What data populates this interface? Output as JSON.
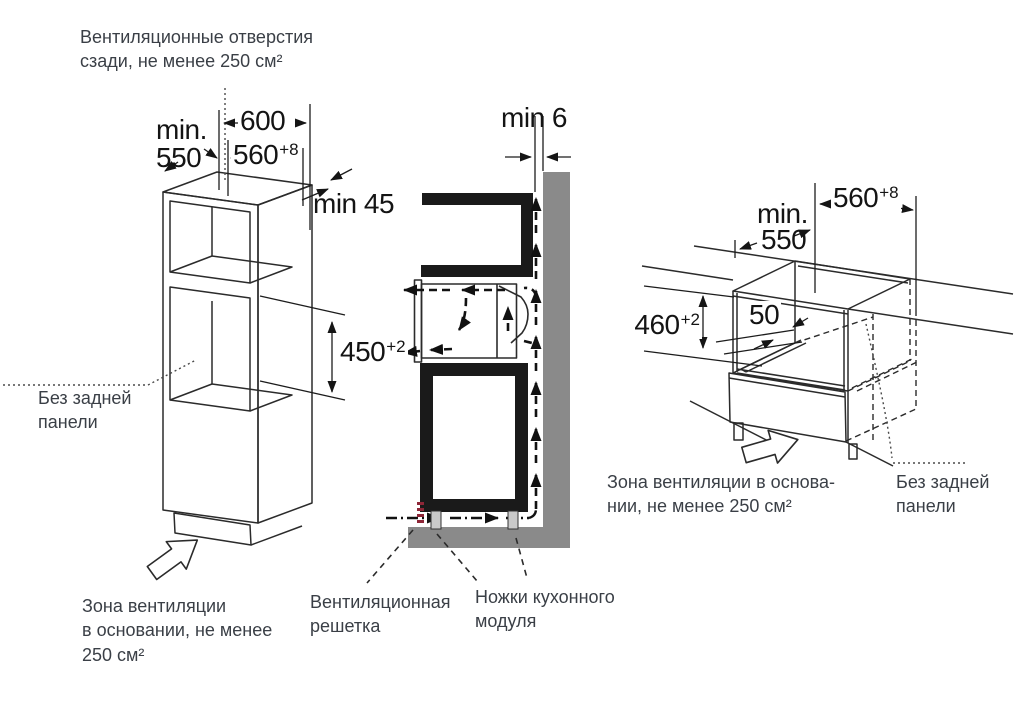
{
  "notes": {
    "vent_top": [
      "Вентиляционные отверстия",
      "сзади, не менее 250 см²"
    ],
    "no_back_left": [
      "Без задней",
      "панели"
    ],
    "zone_left": [
      "Зона вентиляции",
      "в основании, не менее",
      "250 см²"
    ],
    "grille": [
      "Вентиляционная",
      "решетка"
    ],
    "feet": [
      "Ножки кухонного",
      "модуля"
    ],
    "zone_right": [
      "Зона вентиляции в основа-",
      "нии, не менее 250 см²"
    ],
    "no_back_right": [
      "Без задней",
      "панели"
    ]
  },
  "dims": {
    "left": {
      "min_label": "min.",
      "min_value": "550",
      "width_600": "600",
      "width_560": "560",
      "width_560_sup": "+8",
      "gap_top": "min 45",
      "niche_height": "450",
      "niche_height_sup": "+2"
    },
    "middle": {
      "wall_gap": "min 6"
    },
    "right": {
      "min_label": "min.",
      "min_value": "550",
      "width_560": "560",
      "width_560_sup": "+8",
      "niche_height": "460",
      "niche_height_sup": "+2",
      "rail_offset": "50"
    }
  },
  "colors": {
    "line": "#2b2b2b",
    "cabinet_black": "#1a1a1a",
    "wall_gray": "#8a8a8a",
    "foot_gray": "#c9c9c9",
    "grille_red": "#8e2637",
    "note_text": "#3a3f46",
    "dim_text": "#141414"
  }
}
